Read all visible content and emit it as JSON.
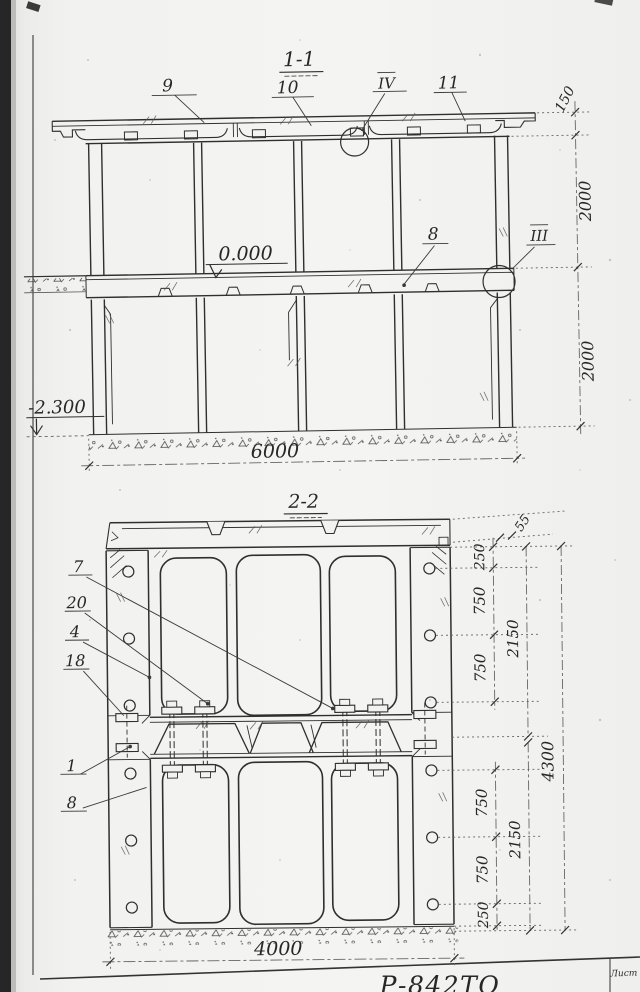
{
  "sheet": {
    "code": "Р-842ТО",
    "sheet_box_label": "Лист"
  },
  "section1": {
    "title": "1-1",
    "callout_9": "9",
    "callout_10": "10",
    "callout_IV": "IV",
    "callout_11": "11",
    "callout_8": "8",
    "callout_III": "III",
    "level_zero": "0.000",
    "level_bottom": "-2.300",
    "dim_roof": "150",
    "dim_upper": "2000",
    "dim_lower": "2000",
    "dim_width": "6000"
  },
  "section2": {
    "title": "2-2",
    "callout_7": "7",
    "callout_20": "20",
    "callout_4": "4",
    "callout_18": "18",
    "callout_1": "1",
    "callout_8": "8",
    "dim_55": "55",
    "dim_250_top": "250",
    "dim_750_a": "750",
    "dim_750_b": "750",
    "dim_2150_top": "2150",
    "dim_750_c": "750",
    "dim_750_d": "750",
    "dim_250_bottom": "250",
    "dim_2150_bottom": "2150",
    "dim_4300": "4300",
    "dim_width": "4000"
  }
}
